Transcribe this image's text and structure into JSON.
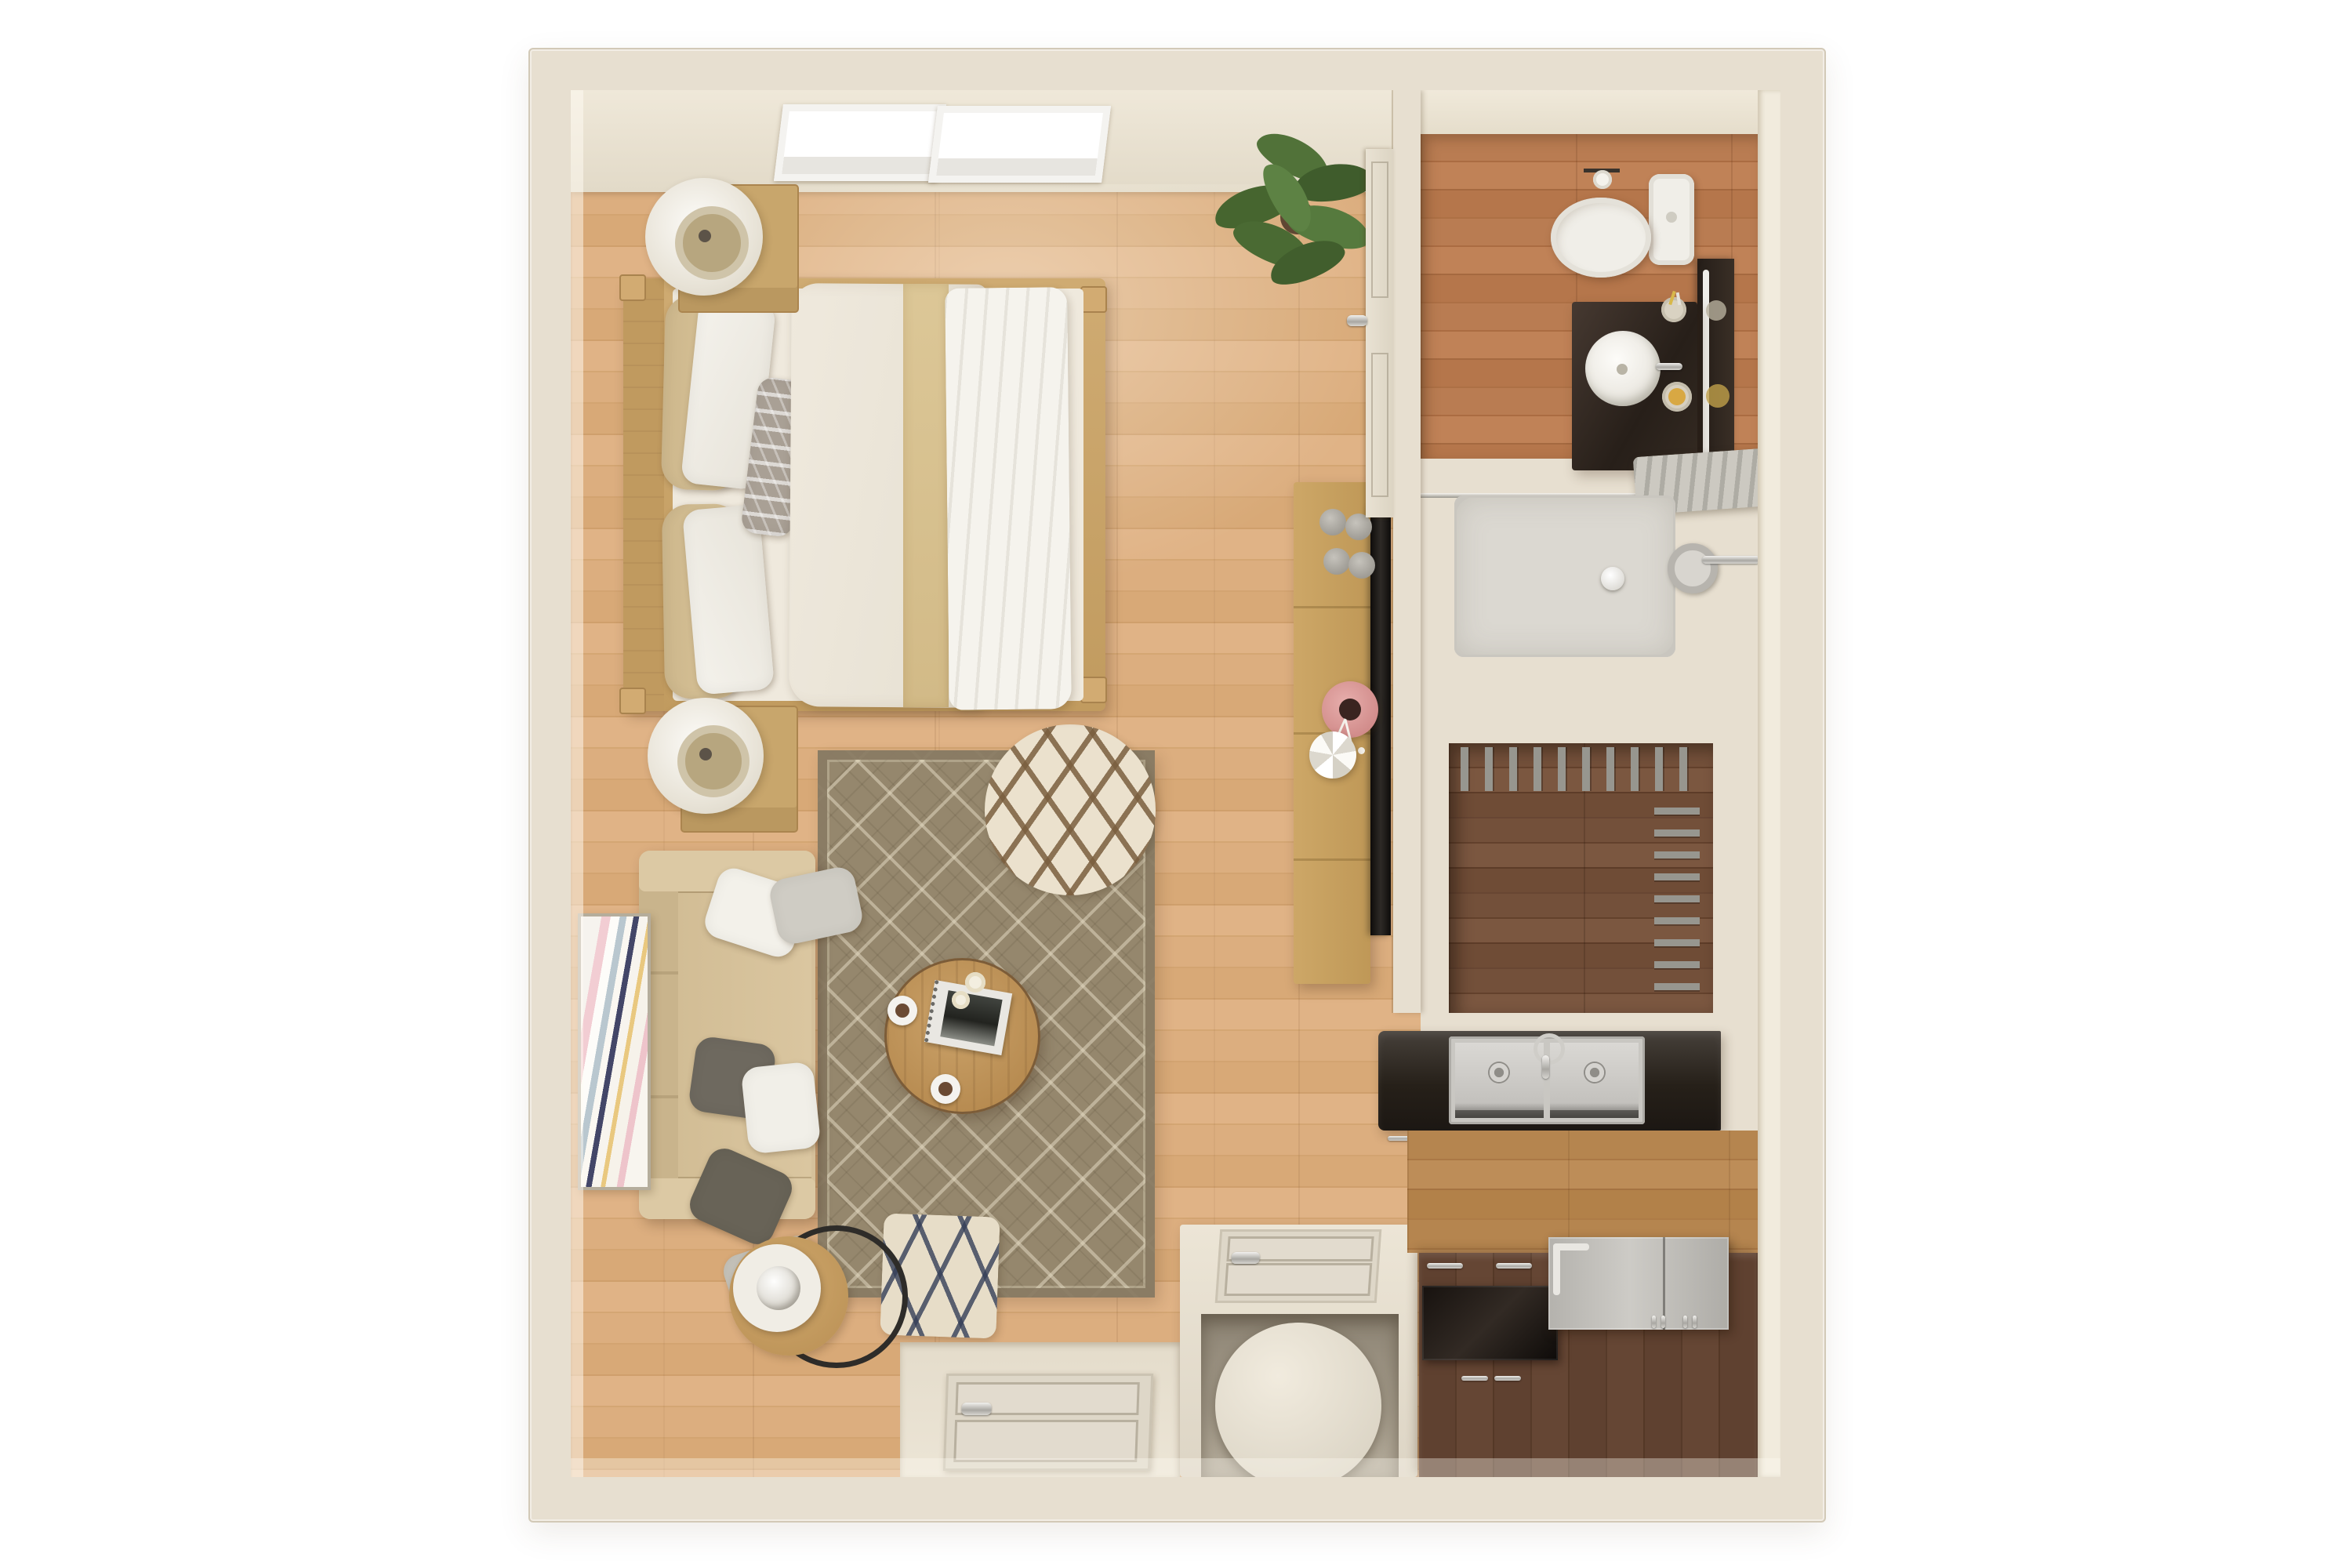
{
  "scene": {
    "type": "floor-plan-3d-render",
    "view": "top-down",
    "subject": "studio-apartment",
    "rooms": [
      "bedroom-living-area",
      "bathroom",
      "shower",
      "walk-in-closet",
      "kitchen",
      "entry"
    ]
  },
  "legend": {
    "bedroom_living": [
      "skylight x2",
      "double-bed with pillows and duvet",
      "nightstand-with-sphere-lamp x2",
      "potted-plant",
      "media-console",
      "tv",
      "decor-cups",
      "pink-vase-with-flowers",
      "white-faceted-vase",
      "area-rug",
      "sofa-with-six-pillows",
      "round-coffee-table with book, two coffee cups, candles",
      "round-lattice-pouf",
      "square-moroccan-pouf",
      "round-side-table-with-lamp",
      "abstract-wall-art",
      "bathroom-door"
    ],
    "bathroom": [
      "toilet",
      "toilet-paper-holder",
      "dark-vanity",
      "round-vessel-sink",
      "faucet",
      "toothbrush-cup",
      "soap-dish",
      "wall-mirror"
    ],
    "shower": [
      "glass-partition",
      "hanging-towel",
      "shower-pan",
      "shower-head",
      "drain"
    ],
    "walk_in_closet": [
      "top-hanging-rod-with-hangers",
      "side-hanging-rod-with-hangers"
    ],
    "kitchen": [
      "dark-countertop",
      "double-bowl-stainless-sink",
      "gooseneck-faucet",
      "cabinet-handles",
      "glossy-cooktop",
      "stainless-refrigerator",
      "walnut-base-cabinets",
      "white-storage-nook",
      "round-stool"
    ],
    "entry": [
      "entry-door",
      "door-threshold"
    ]
  },
  "colors": {
    "bg": "#ffffff",
    "wall": "#e7dfd0",
    "wallFace": "#f1ebdd",
    "floorLiving": "#d7a877",
    "floorBath": "#b3754a",
    "floorCloset": "#6b4832",
    "floorKitchen": "#b07e4a",
    "rug": "#95876d",
    "sofa": "#d5c09a",
    "bedLinen": "#ece6da",
    "tanBand": "#d8c18f",
    "oak": "#c8a66c",
    "walnutCabinet": "#5c3f2d",
    "counterDark": "#262019",
    "stainless": "#bdbbb6",
    "fixtureWhite": "#f0eee8",
    "showerPan": "#dbd8d1",
    "vanityDark": "#362b22",
    "plantGreen": "#4e6d3b",
    "pinkVase": "#dc9e9c",
    "accentYellow": "#d8a843"
  }
}
